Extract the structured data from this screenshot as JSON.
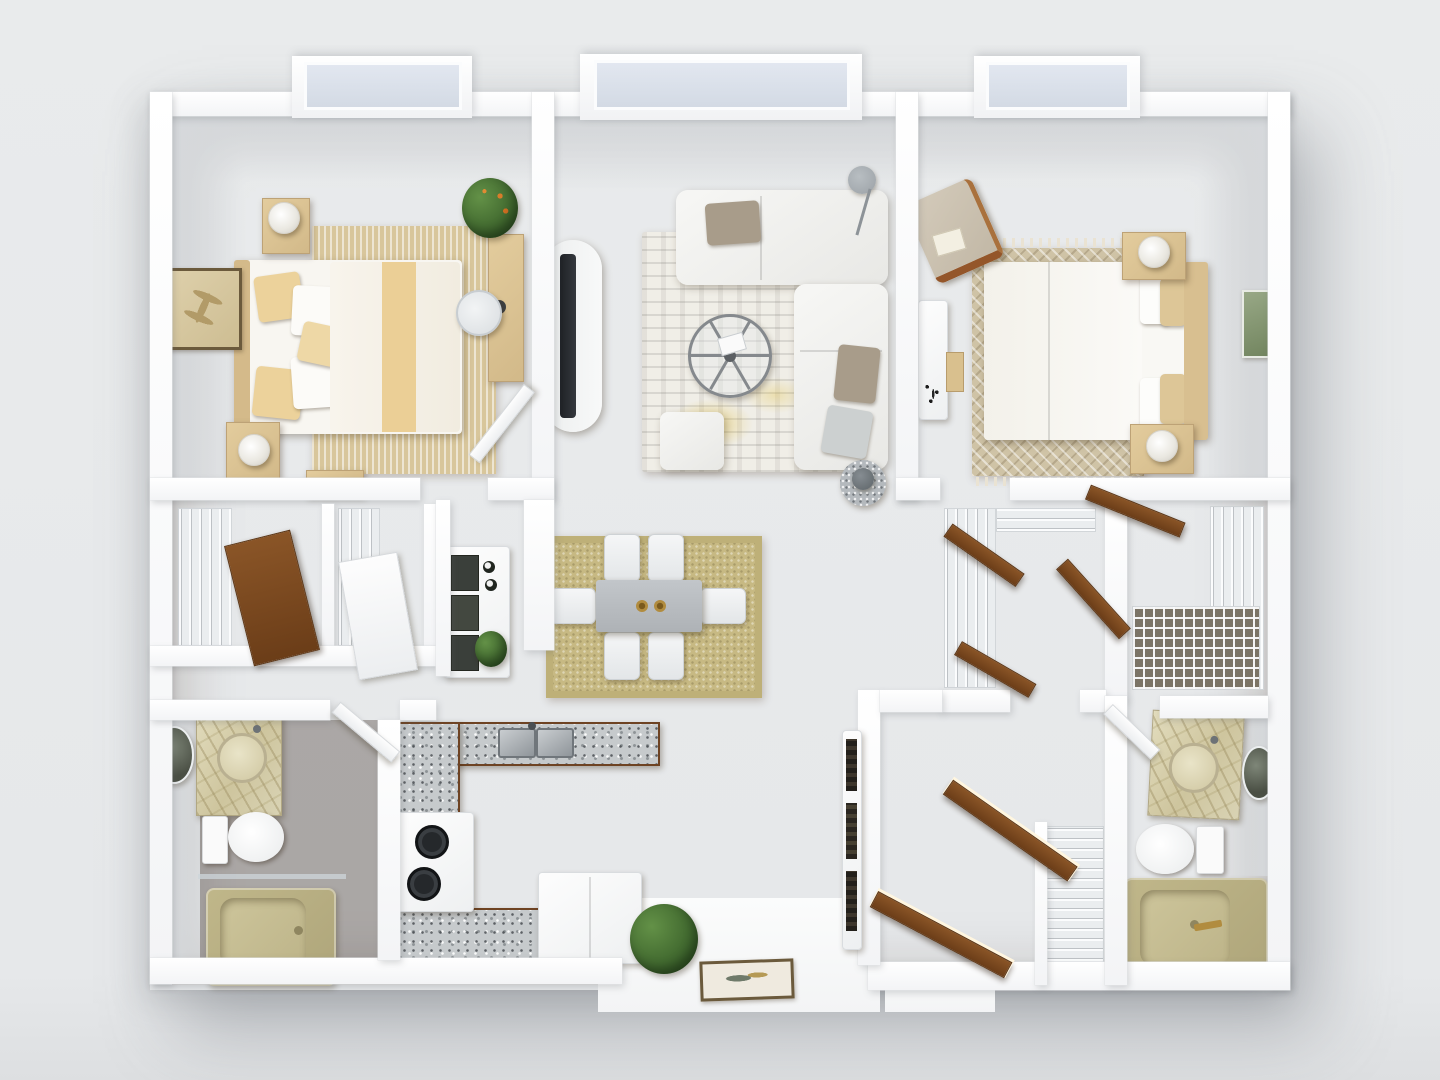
{
  "scene": {
    "type": "3d-floor-plan-render",
    "description": "Top-down 3D rendering of a two-bedroom, two-bathroom apartment floor plan with wood flooring and white walls on a light gray backdrop"
  },
  "palette": {
    "background": "#e9ebec",
    "wall_white": "#ffffff",
    "wood_mid": "#7a4e2e",
    "wood_dark": "#5e3a22",
    "wood_light": "#8a5a36",
    "door_wood": "#6b3d18",
    "bedding_tan": "#e3cc9d",
    "sofa_white": "#f7f7f5",
    "rug_tan": "#d8c69b",
    "rug_sisal": "#c7b983",
    "rug_distressed": "#f0eee7",
    "accent_yellow": "#e2bf3e",
    "granite": "#c6cacc",
    "marble": "#cec59e",
    "tub_khaki": "#c0b78a",
    "glass": "#e2e7f0",
    "plant_green": "#41692f",
    "metal_gray": "#9ba1a6",
    "gold": "#b18c3f"
  },
  "windows": [
    {
      "room": "bedroom-1",
      "style": "bay-window"
    },
    {
      "room": "living-room",
      "style": "bay-window"
    },
    {
      "room": "bedroom-2",
      "style": "bay-window"
    }
  ],
  "rooms": [
    {
      "id": "bedroom-1",
      "furniture": [
        "queen-bed",
        "headboard",
        "nightstand",
        "nightstand",
        "table-lamp",
        "table-lamp",
        "striped-area-rug",
        "desk",
        "desk-chair",
        "potted-plant",
        "palm-leaf-wall-art",
        "door"
      ]
    },
    {
      "id": "living-room",
      "furniture": [
        "l-shaped-sectional-sofa",
        "throw-pillows",
        "oval-media-console",
        "tv",
        "round-metal-coffee-table",
        "ottoman",
        "marble-side-table",
        "vase",
        "floor-lamp",
        "distressed-area-rug"
      ]
    },
    {
      "id": "bedroom-2",
      "furniture": [
        "queen-bed",
        "headboard",
        "nightstand",
        "nightstand",
        "table-lamp",
        "table-lamp",
        "diamond-weave-rug",
        "accent-armchair",
        "console-table",
        "leaf-wall-art",
        "door"
      ]
    },
    {
      "id": "dining-area",
      "furniture": [
        "sisal-rug",
        "dining-table",
        "candle-holders",
        "dining-chair",
        "dining-chair",
        "dining-chair",
        "dining-chair",
        "dining-chair",
        "dining-chair"
      ]
    },
    {
      "id": "kitchen",
      "furniture": [
        "u-shaped-granite-counter",
        "double-basin-sink",
        "range-with-burners",
        "refrigerator",
        "bar-hutch-with-bottles",
        "potted-plant"
      ]
    },
    {
      "id": "bathroom-1",
      "furniture": [
        "marble-vanity",
        "vessel-sink",
        "oval-mirror",
        "toilet",
        "khaki-bathtub",
        "glass-screen",
        "door"
      ]
    },
    {
      "id": "bathroom-2",
      "furniture": [
        "marble-vanity",
        "vessel-sink",
        "oval-mirror",
        "toilet",
        "khaki-bathtub",
        "gold-faucet",
        "door"
      ]
    },
    {
      "id": "closets",
      "furniture": [
        "wire-shelving",
        "bifold-wood-door",
        "walk-in-closet",
        "linen-closet",
        "closet-doors"
      ]
    },
    {
      "id": "hallway-entry",
      "furniture": [
        "bookshelf-with-books",
        "open-entry-doors",
        "framed-art",
        "potted-plant",
        "patio-slab"
      ]
    }
  ]
}
